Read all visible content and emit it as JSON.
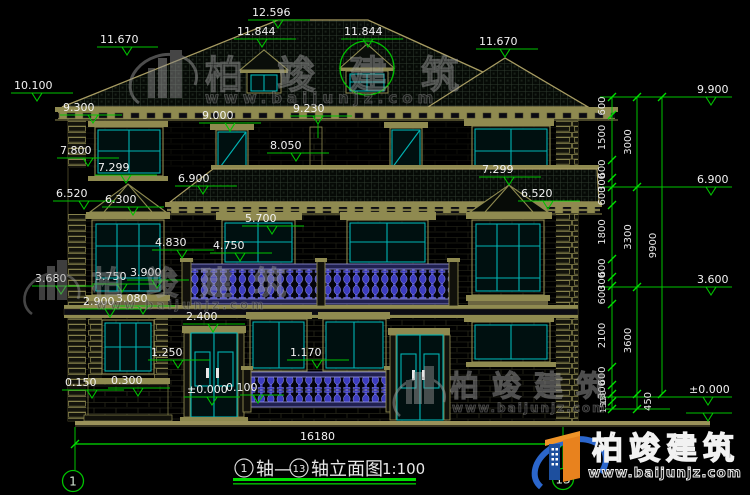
{
  "labels": {
    "ridge": "12.596",
    "roof_left": "11.670",
    "dormer_left": "11.844",
    "dormer_right": "11.844",
    "roof_right": "11.670",
    "eave_left": "10.100",
    "v9300": "9.300",
    "v9000": "9.000",
    "v9230": "9.230",
    "r9900": "9.900",
    "v7800": "7.800",
    "v7299_l": "7.299",
    "v8050": "8.050",
    "v6900_l": "6.900",
    "r6900": "6.900",
    "v6520_l": "6.520",
    "v6300": "6.300",
    "v7299_r": "7.299",
    "v6520_r": "6.520",
    "v5700": "5.700",
    "v4830": "4.830",
    "v4750": "4.750",
    "v3680": "3.680",
    "v3750": "3.750",
    "v3900": "3.900",
    "v2900": "2.900",
    "v3080": "3.080",
    "v2400": "2.400",
    "v1250": "1.250",
    "v1170": "1.170",
    "v0150": "0.150",
    "v0300": "0.300",
    "zero_left": "±0.000",
    "v0100": "0.100",
    "r3600": "3.600",
    "rzero": "±0.000"
  },
  "chains": {
    "inner": [
      "600",
      "1500",
      "600",
      "300",
      "600",
      "1800",
      "600",
      "300",
      "600",
      "2100",
      "600",
      "300"
    ],
    "inner_below": [
      "150",
      "150"
    ],
    "middle": [
      "3000",
      "3300",
      "3600"
    ],
    "middle_below": [
      "450"
    ],
    "outer": [
      "9900"
    ]
  },
  "footer": {
    "total_width": "16180",
    "axis_start": "1",
    "axis_end": "13",
    "title_mid": "轴—",
    "title_end": "轴立面图",
    "scale": "1:100"
  },
  "watermark": {
    "brand": "柏竣建筑",
    "url": "www.baijunjz.com"
  },
  "colors": {
    "dim_green": "#00c300",
    "line_tan": "#8f8a50",
    "window_cyan": "#00b4b4",
    "railing_blue": "#3c3cc0",
    "logo_blue": "#2b66cc",
    "logo_orange": "#e8821e"
  }
}
